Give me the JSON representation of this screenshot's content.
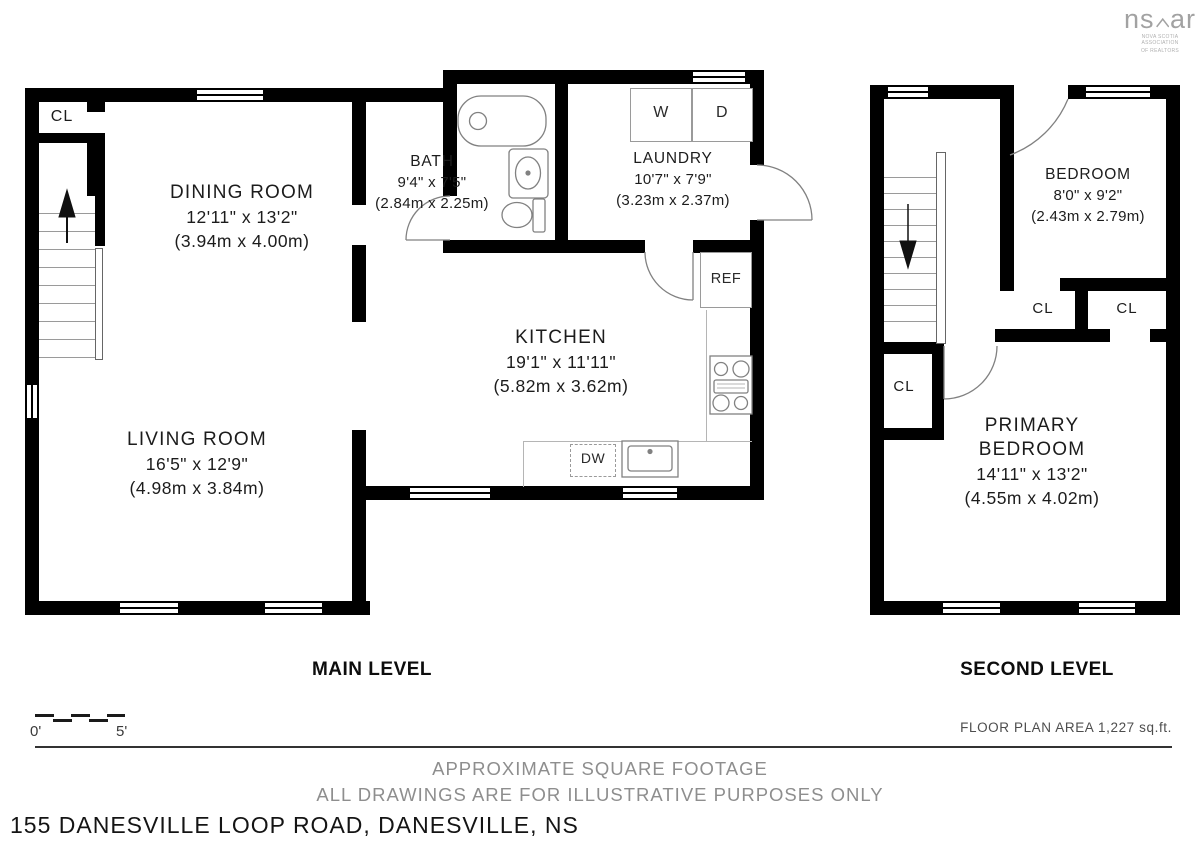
{
  "logo": {
    "brand_left": "ns",
    "brand_right": "ar",
    "tagline1": "NOVA SCOTIA ASSOCIATION",
    "tagline2": "OF REALTORS"
  },
  "main_level": {
    "title": "MAIN LEVEL",
    "closet": "CL",
    "rooms": {
      "dining": {
        "name": "DINING ROOM",
        "dim_ft": "12'11\" x 13'2\"",
        "dim_m": "(3.94m x 4.00m)"
      },
      "bath": {
        "name": "BATH",
        "dim_ft": "9'4\" x 7'5\"",
        "dim_m": "(2.84m x 2.25m)"
      },
      "laundry": {
        "name": "LAUNDRY",
        "dim_ft": "10'7\" x 7'9\"",
        "dim_m": "(3.23m x 2.37m)"
      },
      "kitchen": {
        "name": "KITCHEN",
        "dim_ft": "19'1\" x 11'11\"",
        "dim_m": "(5.82m x 3.62m)"
      },
      "living": {
        "name": "LIVING ROOM",
        "dim_ft": "16'5\" x 12'9\"",
        "dim_m": "(4.98m x 3.84m)"
      }
    },
    "fixtures": {
      "washer": "W",
      "dryer": "D",
      "fridge": "REF",
      "dishwasher": "DW"
    }
  },
  "second_level": {
    "title": "SECOND LEVEL",
    "closet_hall": "CL",
    "closet_bedroom": "CL",
    "closet_primary": "CL",
    "rooms": {
      "bedroom": {
        "name": "BEDROOM",
        "dim_ft": "8'0\" x 9'2\"",
        "dim_m": "(2.43m x 2.79m)"
      },
      "primary": {
        "name": "PRIMARY BEDROOM",
        "dim_ft": "14'11\" x 13'2\"",
        "dim_m": "(4.55m x 4.02m)"
      }
    }
  },
  "footer": {
    "scale_zero": "0'",
    "scale_five": "5'",
    "area_note": "FLOOR PLAN AREA 1,227 sq.ft.",
    "disclaimer_line1": "APPROXIMATE SQUARE FOOTAGE",
    "disclaimer_line2": "ALL DRAWINGS ARE FOR ILLUSTRATIVE PURPOSES ONLY",
    "address": "155 DANESVILLE LOOP ROAD, DANESVILLE, NS"
  },
  "colors": {
    "wall": "#000000",
    "fixture_stroke": "#818181",
    "muted_text": "#8e8e8e"
  }
}
